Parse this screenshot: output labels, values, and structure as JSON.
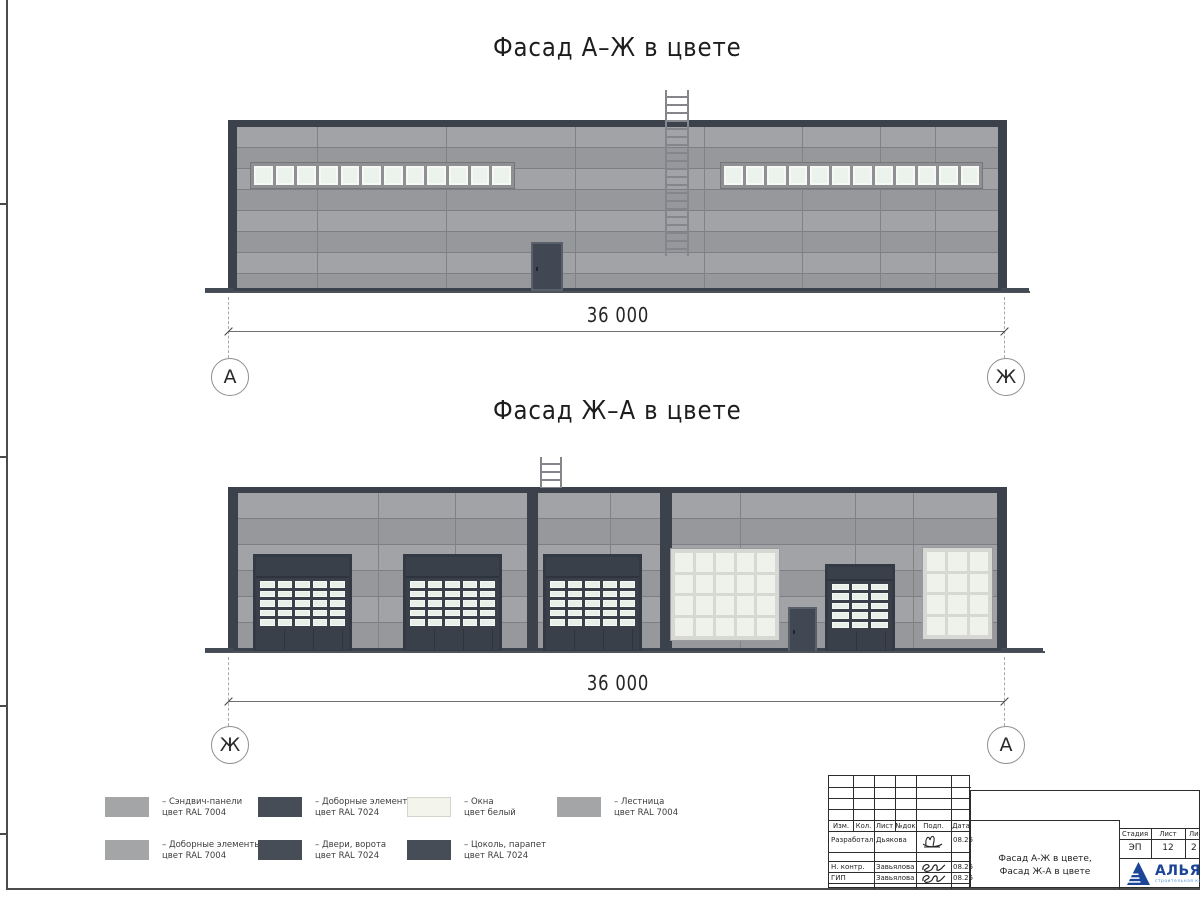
{
  "sheet": {
    "facade1_title": "Фасад А–Ж в цвете",
    "facade2_title": "Фасад Ж–А в цвете",
    "dim1": "36 000",
    "dim2": "36 000",
    "axis1_left": "А",
    "axis1_right": "Ж",
    "axis2_left": "Ж",
    "axis2_right": "А"
  },
  "legend": {
    "items": [
      {
        "line1": "– Сэндвич-панели",
        "line2": "цвет RAL 7004",
        "color": "#a4a5a7"
      },
      {
        "line1": "– Доборные элементы",
        "line2": "цвет RAL 7024",
        "color": "#474d57"
      },
      {
        "line1": "– Окна",
        "line2": "цвет белый",
        "color": "#f3f4ec"
      },
      {
        "line1": "– Лестница",
        "line2": "цвет RAL 7004",
        "color": "#a4a5a7"
      },
      {
        "line1": "– Доборные элементы",
        "line2": "цвет RAL 7004",
        "color": "#a4a5a7"
      },
      {
        "line1": "– Двери, ворота",
        "line2": "цвет RAL 7024",
        "color": "#474d57"
      },
      {
        "line1": "– Цоколь, парапет",
        "line2": "цвет RAL 7024",
        "color": "#474d57"
      }
    ]
  },
  "title_block": {
    "rev_headers": [
      "Изм.",
      "Кол.",
      "Лист",
      "№док",
      "Подп.",
      "Дата"
    ],
    "people": [
      {
        "role": "Разработал",
        "name": "Дьякова",
        "date": "08.25"
      },
      {
        "role": "Н. контр.",
        "name": "Завьялова",
        "date": "08.25"
      },
      {
        "role": "ГИП",
        "name": "Завьялова",
        "date": "08.25"
      }
    ],
    "doc_title_line1": "Фасад А-Ж в цвете,",
    "doc_title_line2": "Фасад Ж-А в цвете",
    "stage_label": "Стадия",
    "sheet_label": "Лист",
    "sheets_label": "Листов",
    "stage_value": "ЭП",
    "sheet_value": "12",
    "sheets_value": "2",
    "company": "АЛЬЯНС",
    "company_sub": "строительная компания"
  }
}
